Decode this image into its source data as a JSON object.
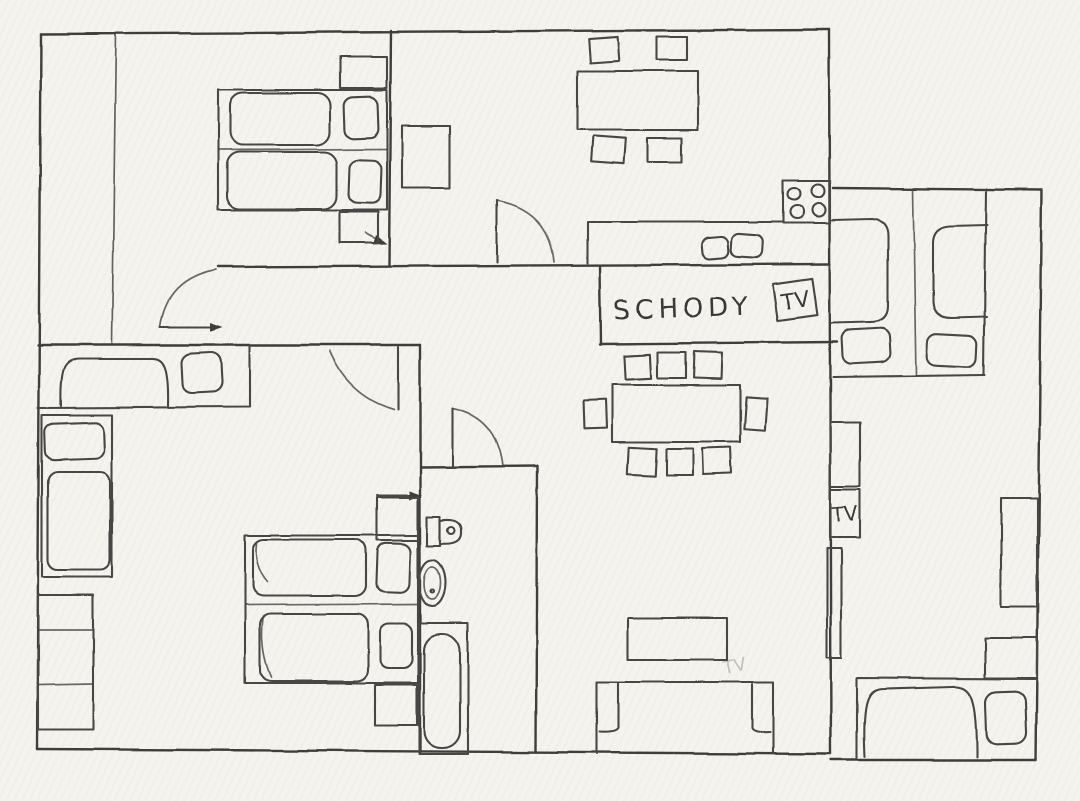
{
  "labels": {
    "stairs": "SCHODY",
    "tv_hall": "TV",
    "tv_cabinet": "TV",
    "tv_faint": "TV"
  },
  "palette": {
    "paper": "#f4f3ee",
    "ink": "#474645"
  },
  "plan": {
    "type": "hand-drawn apartment floor plan sketch",
    "rooms": [
      {
        "name": "bedroom-top-left",
        "furniture": [
          "twin bed x2 with pillows",
          "nightstand x2"
        ]
      },
      {
        "name": "kitchen-dining-top",
        "furniture": [
          "dining table",
          "chair x4",
          "fridge-cabinet",
          "counter with sink x2",
          "stove 4 burners",
          "door"
        ]
      },
      {
        "name": "hallway",
        "furniture": [
          "door x2",
          "entry arrow"
        ]
      },
      {
        "name": "stairs",
        "furniture": [
          "stairs box labeled SCHODY",
          "tilted TV box"
        ]
      },
      {
        "name": "living-dining-center",
        "furniture": [
          "dining table",
          "chair x8",
          "coffee table",
          "sofa"
        ]
      },
      {
        "name": "bedroom-left",
        "furniture": [
          "single bed with pillow x2",
          "double bed block x2 beds with pillows",
          "wardrobe 3 sections",
          "nightstand",
          "shelf",
          "door"
        ]
      },
      {
        "name": "bathroom",
        "furniture": [
          "toilet",
          "sink",
          "bathtub",
          "door"
        ]
      },
      {
        "name": "bedroom-right-top",
        "furniture": [
          "bed with pillow x2"
        ]
      },
      {
        "name": "room-right-bottom",
        "furniture": [
          "cabinet",
          "TV box",
          "radiator-hatched-strip",
          "wardrobe",
          "nightstand",
          "bed with pillow"
        ]
      }
    ]
  }
}
